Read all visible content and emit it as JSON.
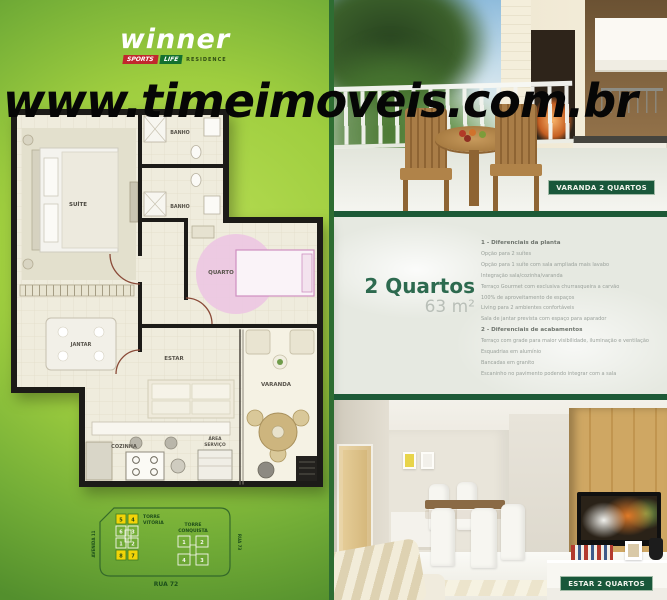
{
  "branding": {
    "name": "winner",
    "tag_sports": "SPORTS",
    "tag_life": "LIFE",
    "tag_residence": "RESIDENCE"
  },
  "watermark": "www.timeimoveis.com.br",
  "unit": {
    "title": "2 Quartos",
    "area": "63 m²"
  },
  "features": {
    "section1": {
      "title": "1 - Diferenciais da planta",
      "items": [
        "Opção para 2 suítes",
        "Opção para 1 suíte com sala ampliada mais lavabo",
        "Integração sala/cozinha/varanda",
        "Terraço Gourmet com exclusiva churrasqueira a carvão",
        "100% de aproveitamento de espaços",
        "Living para 2 ambientes confortáveis",
        "Sala de jantar prevista com espaço para aparador"
      ]
    },
    "section2": {
      "title": "2 - Diferenciais de acabamentos",
      "items": [
        "Terraço com grade para maior visibilidade, iluminação e ventilação",
        "Esquadrias em alumínio",
        "Bancadas em granito",
        "Escaninho no pavimento podendo integrar com a sala"
      ]
    }
  },
  "floorplan": {
    "labels": {
      "suite": "SUÍTE",
      "banho1": "BANHO",
      "banho2": "BANHO",
      "quarto": "QUARTO",
      "jantar": "JANTAR",
      "estar": "ESTAR",
      "varanda": "VARANDA",
      "cozinha": "COZINHA",
      "area1": "ÁREA",
      "area2": "SERVIÇO"
    }
  },
  "siteplan": {
    "tower1_line1": "TORRE",
    "tower1_line2": "VITÓRIA",
    "tower2_line1": "TORRE",
    "tower2_line2": "CONQUISTA",
    "street_bottom": "RUA 72",
    "street_left": "AVENIDA 11",
    "street_right": "RUA 73",
    "tower1_units": [
      "5",
      "4",
      "6",
      "3",
      "1",
      "2",
      "8",
      "7"
    ],
    "tower2_units": [
      "1",
      "2",
      "4",
      "3"
    ]
  },
  "photos": {
    "varanda_badge": "VARANDA 2 QUARTOS",
    "estar_badge": "ESTAR 2 QUARTOS"
  },
  "colors": {
    "badge_green": "#19573a",
    "title_green": "#2d6a4f",
    "separator_green": "#1d5a37",
    "lime_green": "#a8d044",
    "dark_green": "#4e8f2e",
    "highlight_yellow": "#f2d408",
    "logo_red": "#c1272d",
    "logo_green": "#13702f"
  }
}
